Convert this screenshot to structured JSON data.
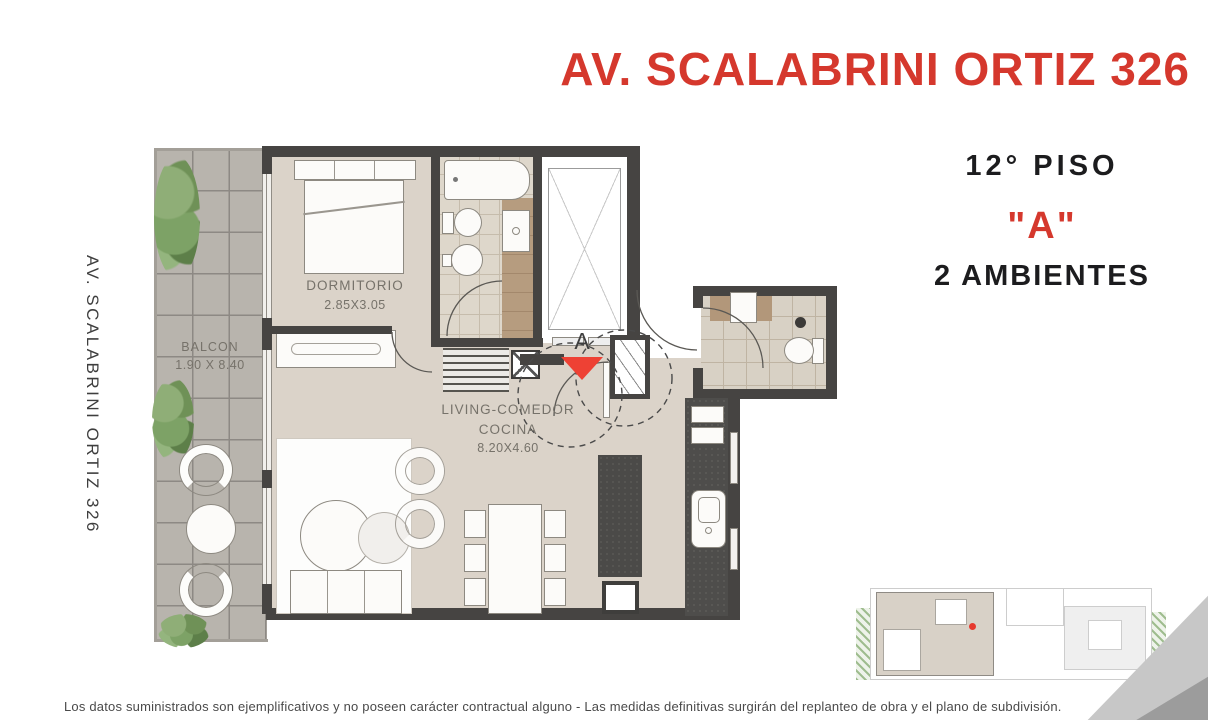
{
  "header": {
    "title": "AV. SCALABRINI ORTIZ 326"
  },
  "side_label": {
    "text": "AV. SCALABRINI ORTIZ 326"
  },
  "unit_info": {
    "floor": "12° PISO",
    "unit": "\"A\"",
    "rooms": "2 AMBIENTES"
  },
  "floor_plan": {
    "bedroom": {
      "name": "DORMITORIO",
      "dims": "2.85X3.05"
    },
    "balcony": {
      "name": "BALCON",
      "dims": "1.90 X 8.40"
    },
    "living": {
      "line1": "LIVING-COMEDOR",
      "line2": "COCINA",
      "dims": "8.20X4.60"
    },
    "entry_marker": "A"
  },
  "footer": {
    "disclaimer": "Los datos suministrados son ejemplificativos y no poseen carácter contractual alguno - Las medidas definitivas surgirán del replanteo de obra y el plano de subdivisión."
  },
  "colors": {
    "accent_red": "#d5382d",
    "marker_red": "#ee4134",
    "wall_dark": "#464442",
    "floor_beige": "#dbd3c9",
    "balcony_gray": "#b8b4ad",
    "text_dark": "#1c1c1e",
    "label_gray": "#76726a"
  }
}
